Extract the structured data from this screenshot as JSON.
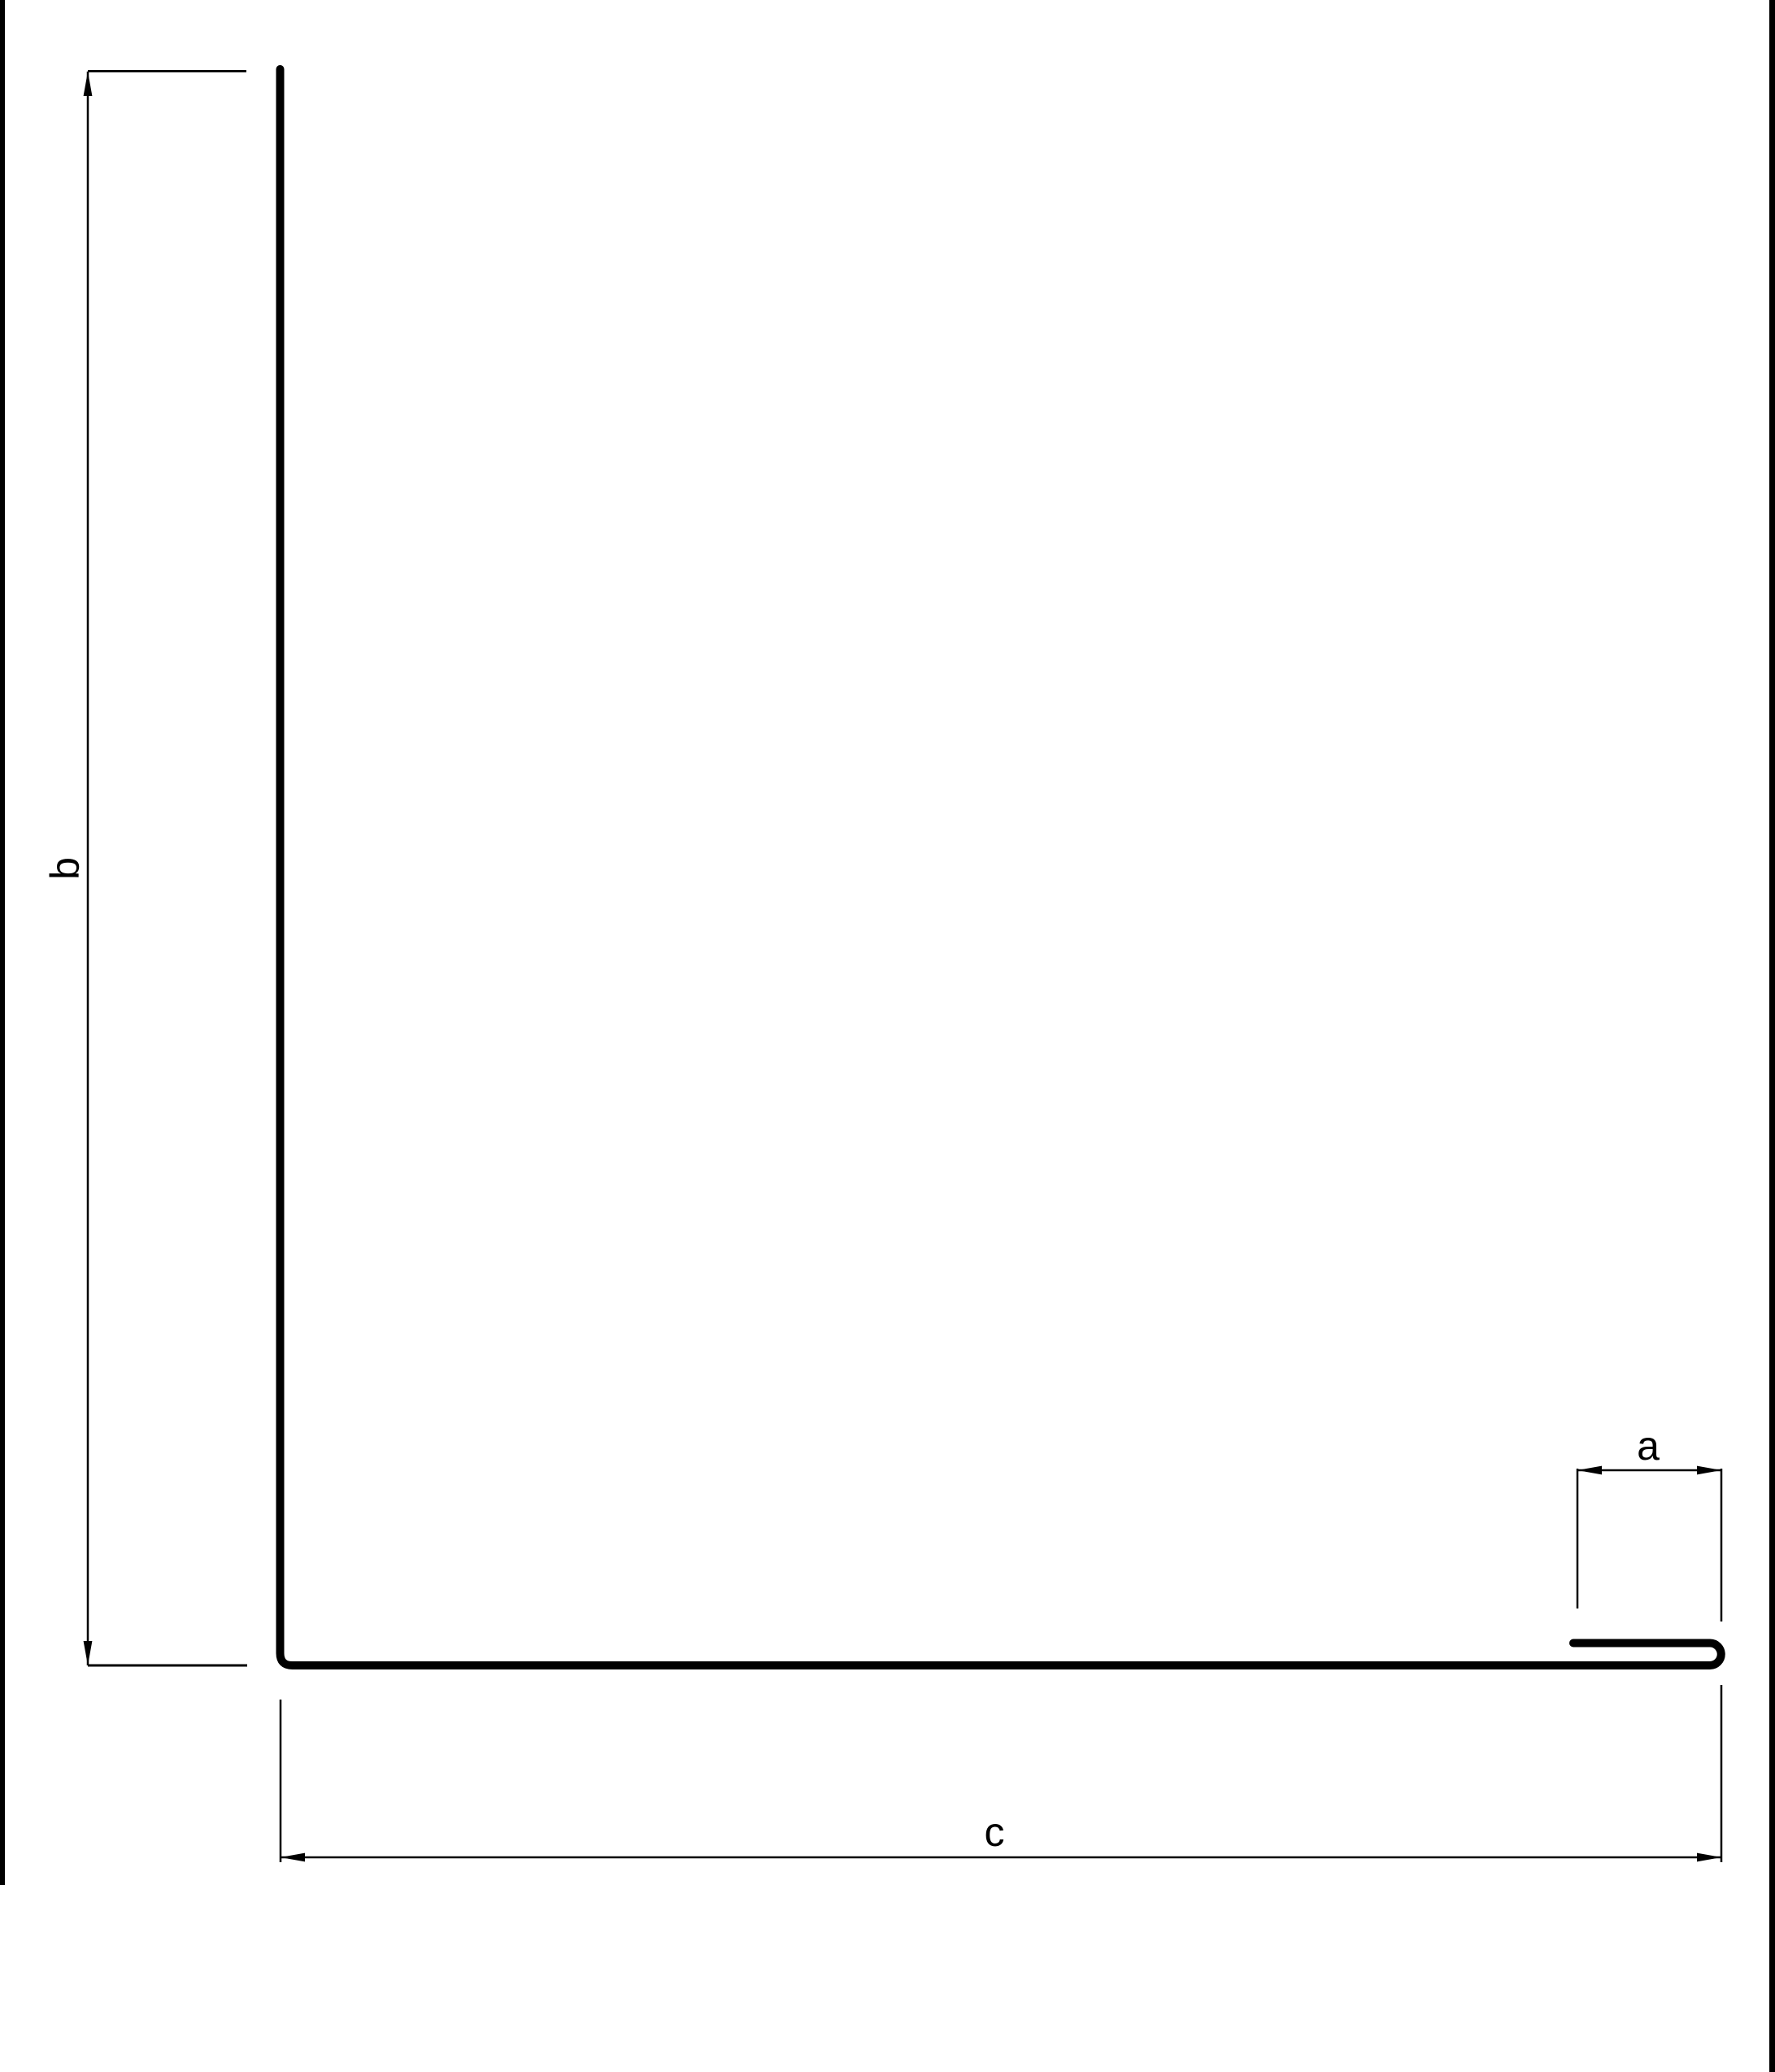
{
  "drawing": {
    "title": "sheet-metal profile cross-section with dimension callouts",
    "dimensions": {
      "a": {
        "label": "a"
      },
      "b": {
        "label": "b"
      },
      "c": {
        "label": "c"
      }
    }
  },
  "colors": {
    "ink": "#000000",
    "background": "#ffffff"
  }
}
